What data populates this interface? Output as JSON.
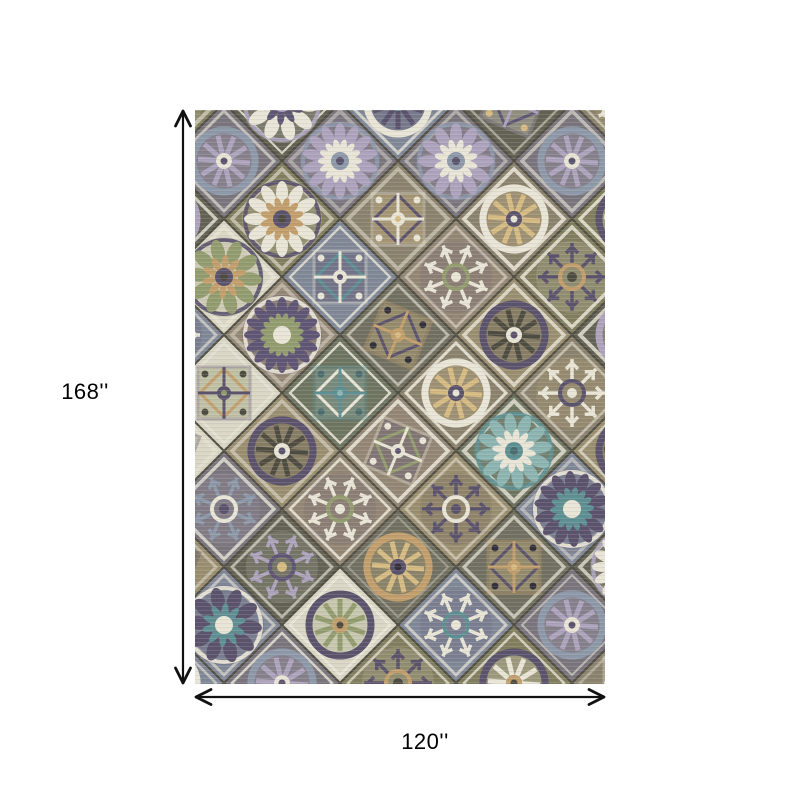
{
  "page": {
    "background_color": "#ffffff"
  },
  "product_image": {
    "name": "patchwork-medallion-area-rug"
  },
  "dimensions": {
    "height_label": "168''",
    "width_label": "120''",
    "arrow_color": "#111111",
    "label_color": "#000000"
  },
  "rug": {
    "base_color": "#847a64",
    "lattice_outline_color": "#4d4a3c",
    "lattice_border_color": "#e9e4d2",
    "schemes": [
      {
        "bg": "#7f7b52",
        "ring": "#584d6e",
        "petal": "#e7e2cf",
        "inner": "#c89a58",
        "center": "#4a483a"
      },
      {
        "bg": "#93826b",
        "ring": "#e7e2cf",
        "petal": "#5d5078",
        "inner": "#8d9a5e",
        "center": "#e7e2cf"
      },
      {
        "bg": "#6e6c58",
        "ring": "#c89a58",
        "petal": "#d9b66e",
        "inner": "#584d6e",
        "center": "#2f2b3a"
      },
      {
        "bg": "#77707a",
        "ring": "#8795ab",
        "petal": "#ab9fc0",
        "inner": "#e7e2cf",
        "center": "#584d6e"
      },
      {
        "bg": "#687258",
        "ring": "#4f8f93",
        "petal": "#7fb3b0",
        "inner": "#e7e2cf",
        "center": "#3f6b6e"
      },
      {
        "bg": "#d9d3bd",
        "ring": "#584d6e",
        "petal": "#8d9a5e",
        "inner": "#c89a58",
        "center": "#4a483a"
      },
      {
        "bg": "#8a7e64",
        "ring": "#e7e2cf",
        "petal": "#d9b66e",
        "inner": "#584d6e",
        "center": "#e7e2cf"
      },
      {
        "bg": "#5f5d4c",
        "ring": "#ab9fc0",
        "petal": "#e7e2cf",
        "inner": "#5d5078",
        "center": "#d9b66e"
      },
      {
        "bg": "#7b8398",
        "ring": "#e7e2cf",
        "petal": "#584d6e",
        "inner": "#4f8f93",
        "center": "#e7e2cf"
      },
      {
        "bg": "#9a8a64",
        "ring": "#584d6e",
        "petal": "#4a483a",
        "inner": "#e7e2cf",
        "center": "#584d6e"
      }
    ]
  }
}
